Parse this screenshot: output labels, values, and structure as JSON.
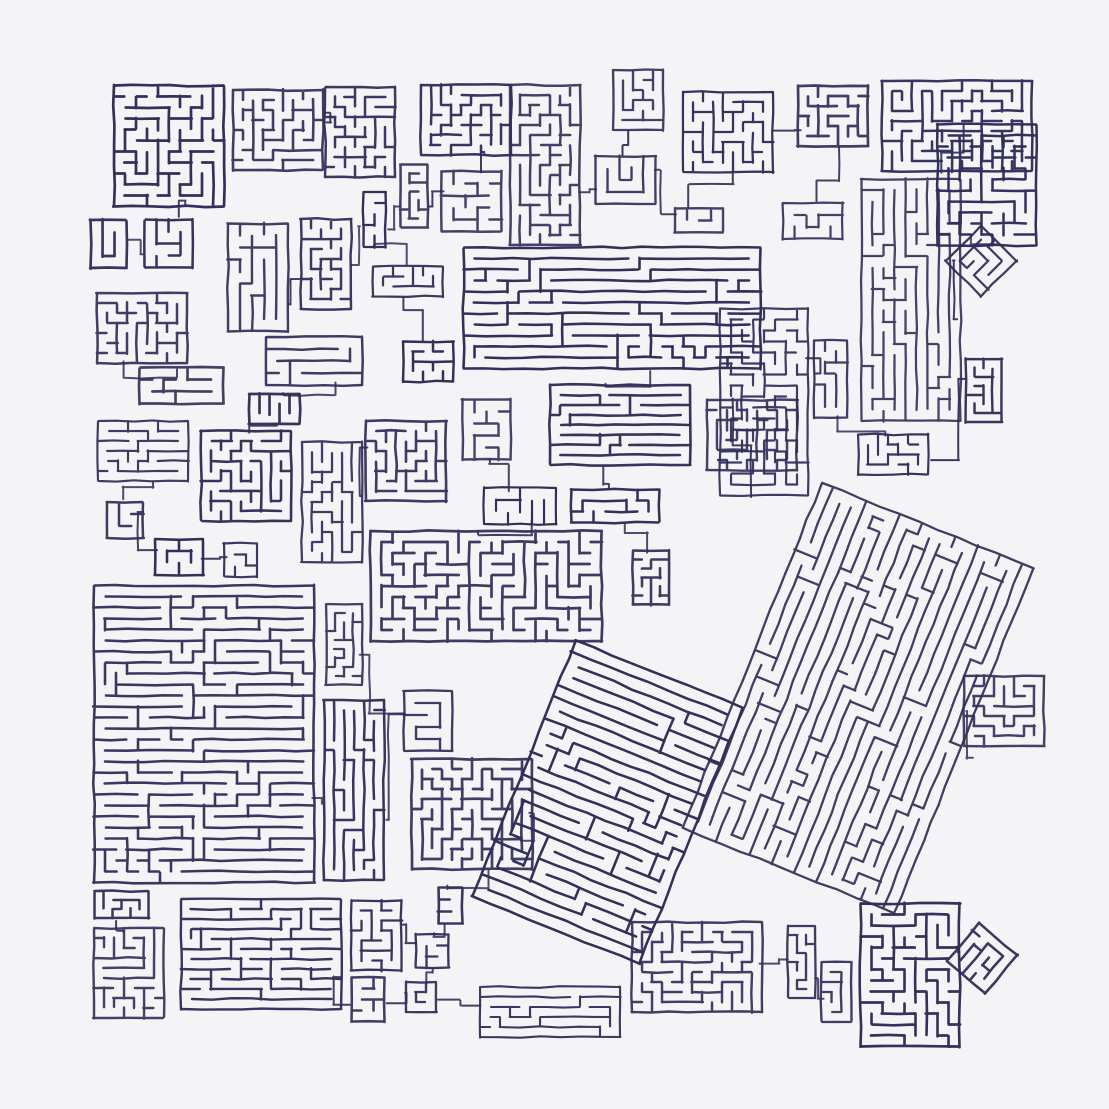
{
  "artwork": {
    "palette": {
      "background": "#f4f4f6",
      "ink": "#312e59"
    },
    "canvas": {
      "width": 1109,
      "height": 1109,
      "margin": 78
    },
    "seed": 20,
    "style": {
      "stroke_min": 2.1,
      "stroke_max": 2.7,
      "echo_width": 1.0,
      "echo_opacity": 0.32,
      "jitter": 0.85,
      "segment_step": 20,
      "connector_width": 2.0
    },
    "featured_blocks": [
      {
        "x": 115,
        "y": 85,
        "w": 108,
        "h": 122,
        "cell": 11,
        "rot": 0,
        "dir": "m"
      },
      {
        "x": 232,
        "y": 92,
        "w": 92,
        "h": 76,
        "cell": 10,
        "rot": 0,
        "dir": "m"
      },
      {
        "x": 326,
        "y": 86,
        "w": 68,
        "h": 92,
        "cell": 10,
        "rot": 0,
        "dir": "m"
      },
      {
        "x": 420,
        "y": 86,
        "w": 92,
        "h": 68,
        "cell": 10,
        "rot": 0,
        "dir": "m"
      },
      {
        "x": 512,
        "y": 86,
        "w": 66,
        "h": 158,
        "cell": 10,
        "rot": 0,
        "dir": "m"
      },
      {
        "x": 612,
        "y": 70,
        "w": 52,
        "h": 60,
        "cell": 10,
        "rot": 0,
        "dir": "m"
      },
      {
        "x": 682,
        "y": 92,
        "w": 92,
        "h": 80,
        "cell": 10,
        "rot": 0,
        "dir": "m"
      },
      {
        "x": 800,
        "y": 84,
        "w": 66,
        "h": 64,
        "cell": 10,
        "rot": 0,
        "dir": "m"
      },
      {
        "x": 884,
        "y": 80,
        "w": 146,
        "h": 92,
        "cell": 10,
        "rot": 0,
        "dir": "m"
      },
      {
        "x": 938,
        "y": 126,
        "w": 98,
        "h": 118,
        "cell": 11,
        "rot": 0,
        "dir": "m"
      },
      {
        "x": 864,
        "y": 180,
        "w": 94,
        "h": 240,
        "cell": 11,
        "rot": 0,
        "dir": "v"
      },
      {
        "x": 954,
        "y": 234,
        "w": 54,
        "h": 54,
        "cell": 10,
        "rot": 45,
        "dir": "m"
      },
      {
        "x": 465,
        "y": 246,
        "w": 294,
        "h": 124,
        "cell": 11,
        "rot": 0,
        "dir": "h"
      },
      {
        "x": 722,
        "y": 306,
        "w": 84,
        "h": 192,
        "cell": 11,
        "rot": 0,
        "dir": "m"
      },
      {
        "x": 96,
        "y": 294,
        "w": 92,
        "h": 68,
        "cell": 10,
        "rot": 0,
        "dir": "m"
      },
      {
        "x": 96,
        "y": 420,
        "w": 94,
        "h": 62,
        "cell": 10,
        "rot": 0,
        "dir": "h"
      },
      {
        "x": 200,
        "y": 432,
        "w": 92,
        "h": 88,
        "cell": 10,
        "rot": 0,
        "dir": "m"
      },
      {
        "x": 302,
        "y": 444,
        "w": 60,
        "h": 116,
        "cell": 10,
        "rot": 0,
        "dir": "v"
      },
      {
        "x": 368,
        "y": 422,
        "w": 76,
        "h": 78,
        "cell": 10,
        "rot": 0,
        "dir": "m"
      },
      {
        "x": 548,
        "y": 384,
        "w": 144,
        "h": 82,
        "cell": 10,
        "rot": 0,
        "dir": "h"
      },
      {
        "x": 706,
        "y": 398,
        "w": 92,
        "h": 74,
        "cell": 10,
        "rot": 0,
        "dir": "m"
      },
      {
        "x": 370,
        "y": 530,
        "w": 232,
        "h": 112,
        "cell": 11,
        "rot": 0,
        "dir": "m"
      },
      {
        "x": 96,
        "y": 586,
        "w": 216,
        "h": 296,
        "cell": 11,
        "rot": 0,
        "dir": "h"
      },
      {
        "x": 322,
        "y": 698,
        "w": 64,
        "h": 184,
        "cell": 10,
        "rot": 0,
        "dir": "v"
      },
      {
        "x": 414,
        "y": 758,
        "w": 116,
        "h": 112,
        "cell": 10,
        "rot": 0,
        "dir": "m"
      },
      {
        "x": 520,
        "y": 664,
        "w": 175,
        "h": 276,
        "cell": 12,
        "rot": 22,
        "dir": "h"
      },
      {
        "x": 742,
        "y": 512,
        "w": 232,
        "h": 372,
        "cell": 12,
        "rot": 22,
        "dir": "v"
      },
      {
        "x": 966,
        "y": 676,
        "w": 76,
        "h": 70,
        "cell": 10,
        "rot": 0,
        "dir": "m"
      },
      {
        "x": 180,
        "y": 898,
        "w": 162,
        "h": 112,
        "cell": 10,
        "rot": 0,
        "dir": "h"
      },
      {
        "x": 480,
        "y": 986,
        "w": 140,
        "h": 52,
        "cell": 10,
        "rot": 0,
        "dir": "h"
      },
      {
        "x": 634,
        "y": 922,
        "w": 126,
        "h": 90,
        "cell": 10,
        "rot": 0,
        "dir": "m"
      },
      {
        "x": 862,
        "y": 906,
        "w": 96,
        "h": 138,
        "cell": 11,
        "rot": 0,
        "dir": "m"
      },
      {
        "x": 956,
        "y": 932,
        "w": 52,
        "h": 52,
        "cell": 10,
        "rot": 40,
        "dir": "m"
      },
      {
        "x": 94,
        "y": 930,
        "w": 70,
        "h": 86,
        "cell": 10,
        "rot": 0,
        "dir": "m"
      }
    ],
    "scatter": {
      "count": 58,
      "min_size": 26,
      "max_size": 88,
      "wide_chance": 0.22,
      "tall_chance": 0.14,
      "tilt_chance": 0.1,
      "cell_min": 9,
      "cell_max": 12,
      "pad": 7
    },
    "connectors": {
      "max_distance": 280,
      "bend_jitter": 14
    }
  }
}
